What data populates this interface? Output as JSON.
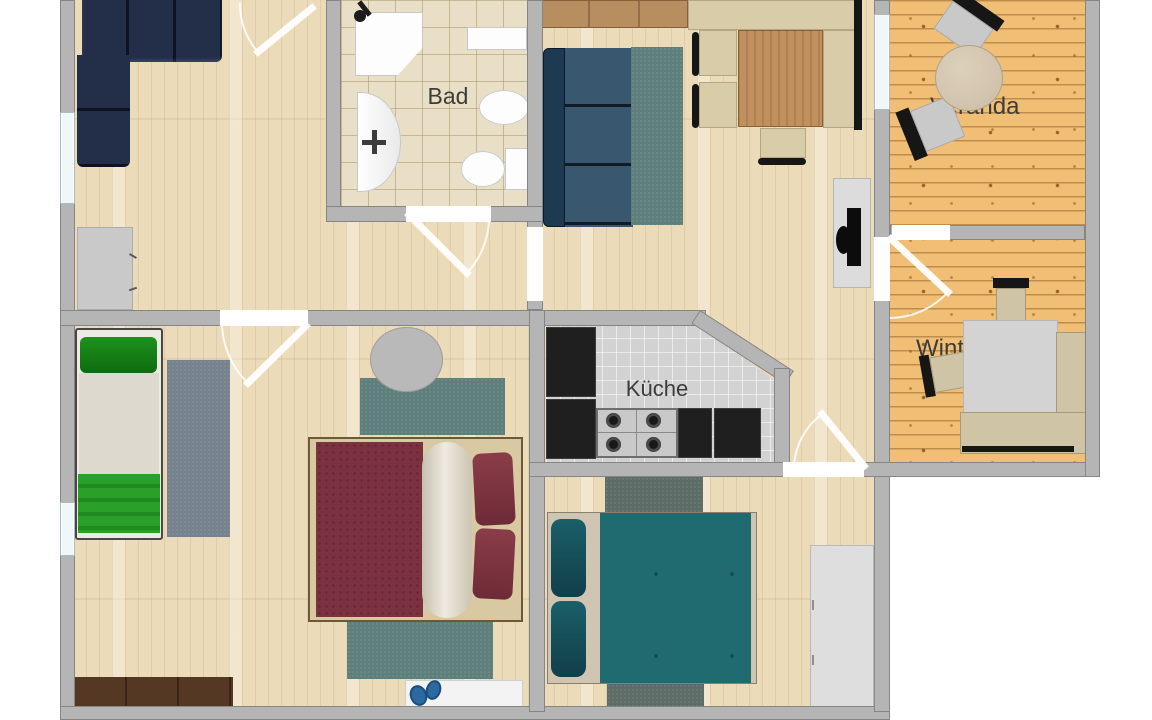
{
  "labels": {
    "bathroom": "Bad",
    "kitchen": "Küche",
    "veranda": "Veranda",
    "wintergarten": "Wintergarten"
  },
  "colors": {
    "wall": "#b5b5b5",
    "wall_edge": "#8d8d8d",
    "floor_wood": "#ecdbb9",
    "floor_pine": "#f0bf75",
    "floor_tile_bath": "#e9dfc6",
    "floor_tile_kitchen": "#d2d2d2",
    "sofa_navy": "#232e49",
    "couch_slate": "#3a5770",
    "rug_teal": "#5e7e7b",
    "rug_gray": "#75818c",
    "rug_dark": "#5b6b66",
    "bed_green_pillow": "#1b8a1b",
    "bed_green_blanket": "#2aa02a",
    "bed_red": "#7b3140",
    "bed_teal": "#1f6b70",
    "bed_teal_pillow": "#14525c",
    "counter_black": "#1f1f1f",
    "table_wood": "#c0915f",
    "bench_beige": "#d9cda9",
    "wardrobe_brown": "#553823",
    "label_text": "#3c3c3c"
  }
}
